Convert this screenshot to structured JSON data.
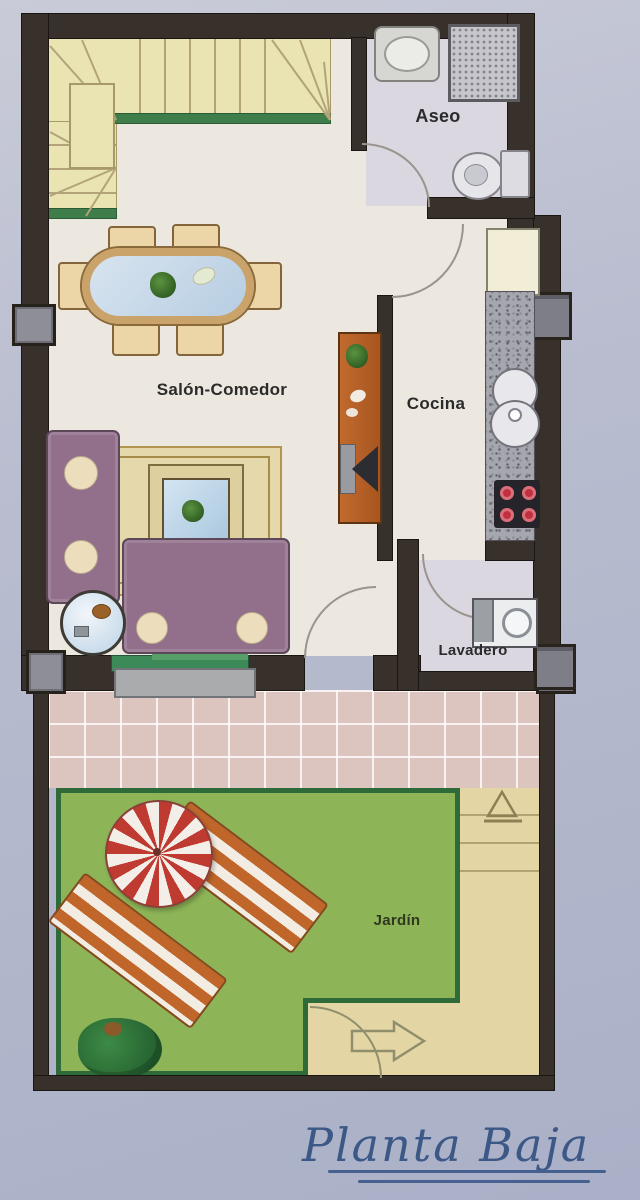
{
  "plan": {
    "title": "Planta Baja",
    "rooms": {
      "aseo": "Aseo",
      "salon_comedor": "Salón-Comedor",
      "cocina": "Cocina",
      "lavadero": "Lavadero",
      "jardin": "Jardín"
    },
    "colors": {
      "background": "#b9bdcf",
      "wall": "#38302a",
      "floor": "#ece7df",
      "wet_room_floor": "#dad7e1",
      "stairs": "#e9e4b2",
      "stairs_edge_green": "#3f7d4b",
      "terrace_tile": "#dcc5bf",
      "lawn": "#8db457",
      "lawn_border": "#2e6b38",
      "path": "#e4d6a4",
      "sofa": "#92708c",
      "rug": "#e5d8ab",
      "wood_sideboard": "#b4622a",
      "umbrella_red": "#bf3a31",
      "lounger_orange": "#c0662a",
      "stove_burner_red": "#c23040",
      "title_blue": "#3c5886"
    },
    "furniture": [
      "stairs",
      "dining-table",
      "dining-chairs",
      "rug",
      "coffee-table",
      "sofa",
      "chaise-sofa",
      "side-table",
      "tv-sideboard",
      "washbasin",
      "shower",
      "toilet",
      "fridge",
      "kitchen-counter",
      "kitchen-sink",
      "stove",
      "washing-machine",
      "sliding-door",
      "step",
      "umbrella",
      "sun-lounger",
      "bush",
      "gate-arrow",
      "path-marker",
      "windows",
      "pillars"
    ]
  }
}
